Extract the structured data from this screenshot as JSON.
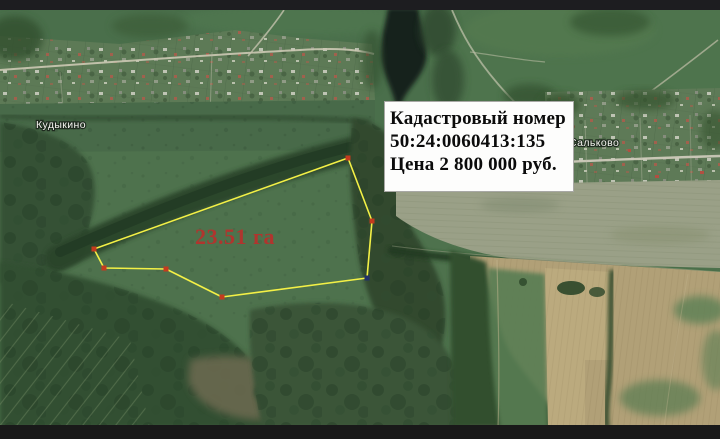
{
  "info_box": {
    "title": "Кадастровый номер",
    "cadastral_number": "50:24:0060413:135",
    "price": "Цена 2 800 000 руб."
  },
  "parcel": {
    "area_label": "23.51 га",
    "area_label_color": "#b0352e",
    "outline_color": "#f3f046",
    "polygon_points": "348,158 372,221 367,278 222,297 166,269 104,268 94,249",
    "markers": [
      {
        "x": 348,
        "y": 158,
        "color": "#c43b1e"
      },
      {
        "x": 372,
        "y": 221,
        "color": "#c43b1e"
      },
      {
        "x": 367,
        "y": 278,
        "color": "#233169"
      },
      {
        "x": 222,
        "y": 297,
        "color": "#c43b1e"
      },
      {
        "x": 166,
        "y": 269,
        "color": "#c43b1e"
      },
      {
        "x": 104,
        "y": 268,
        "color": "#c43b1e"
      },
      {
        "x": 94,
        "y": 249,
        "color": "#c43b1e"
      }
    ]
  },
  "places": {
    "left_village": "Кудыкино",
    "right_village": "Сальково"
  }
}
